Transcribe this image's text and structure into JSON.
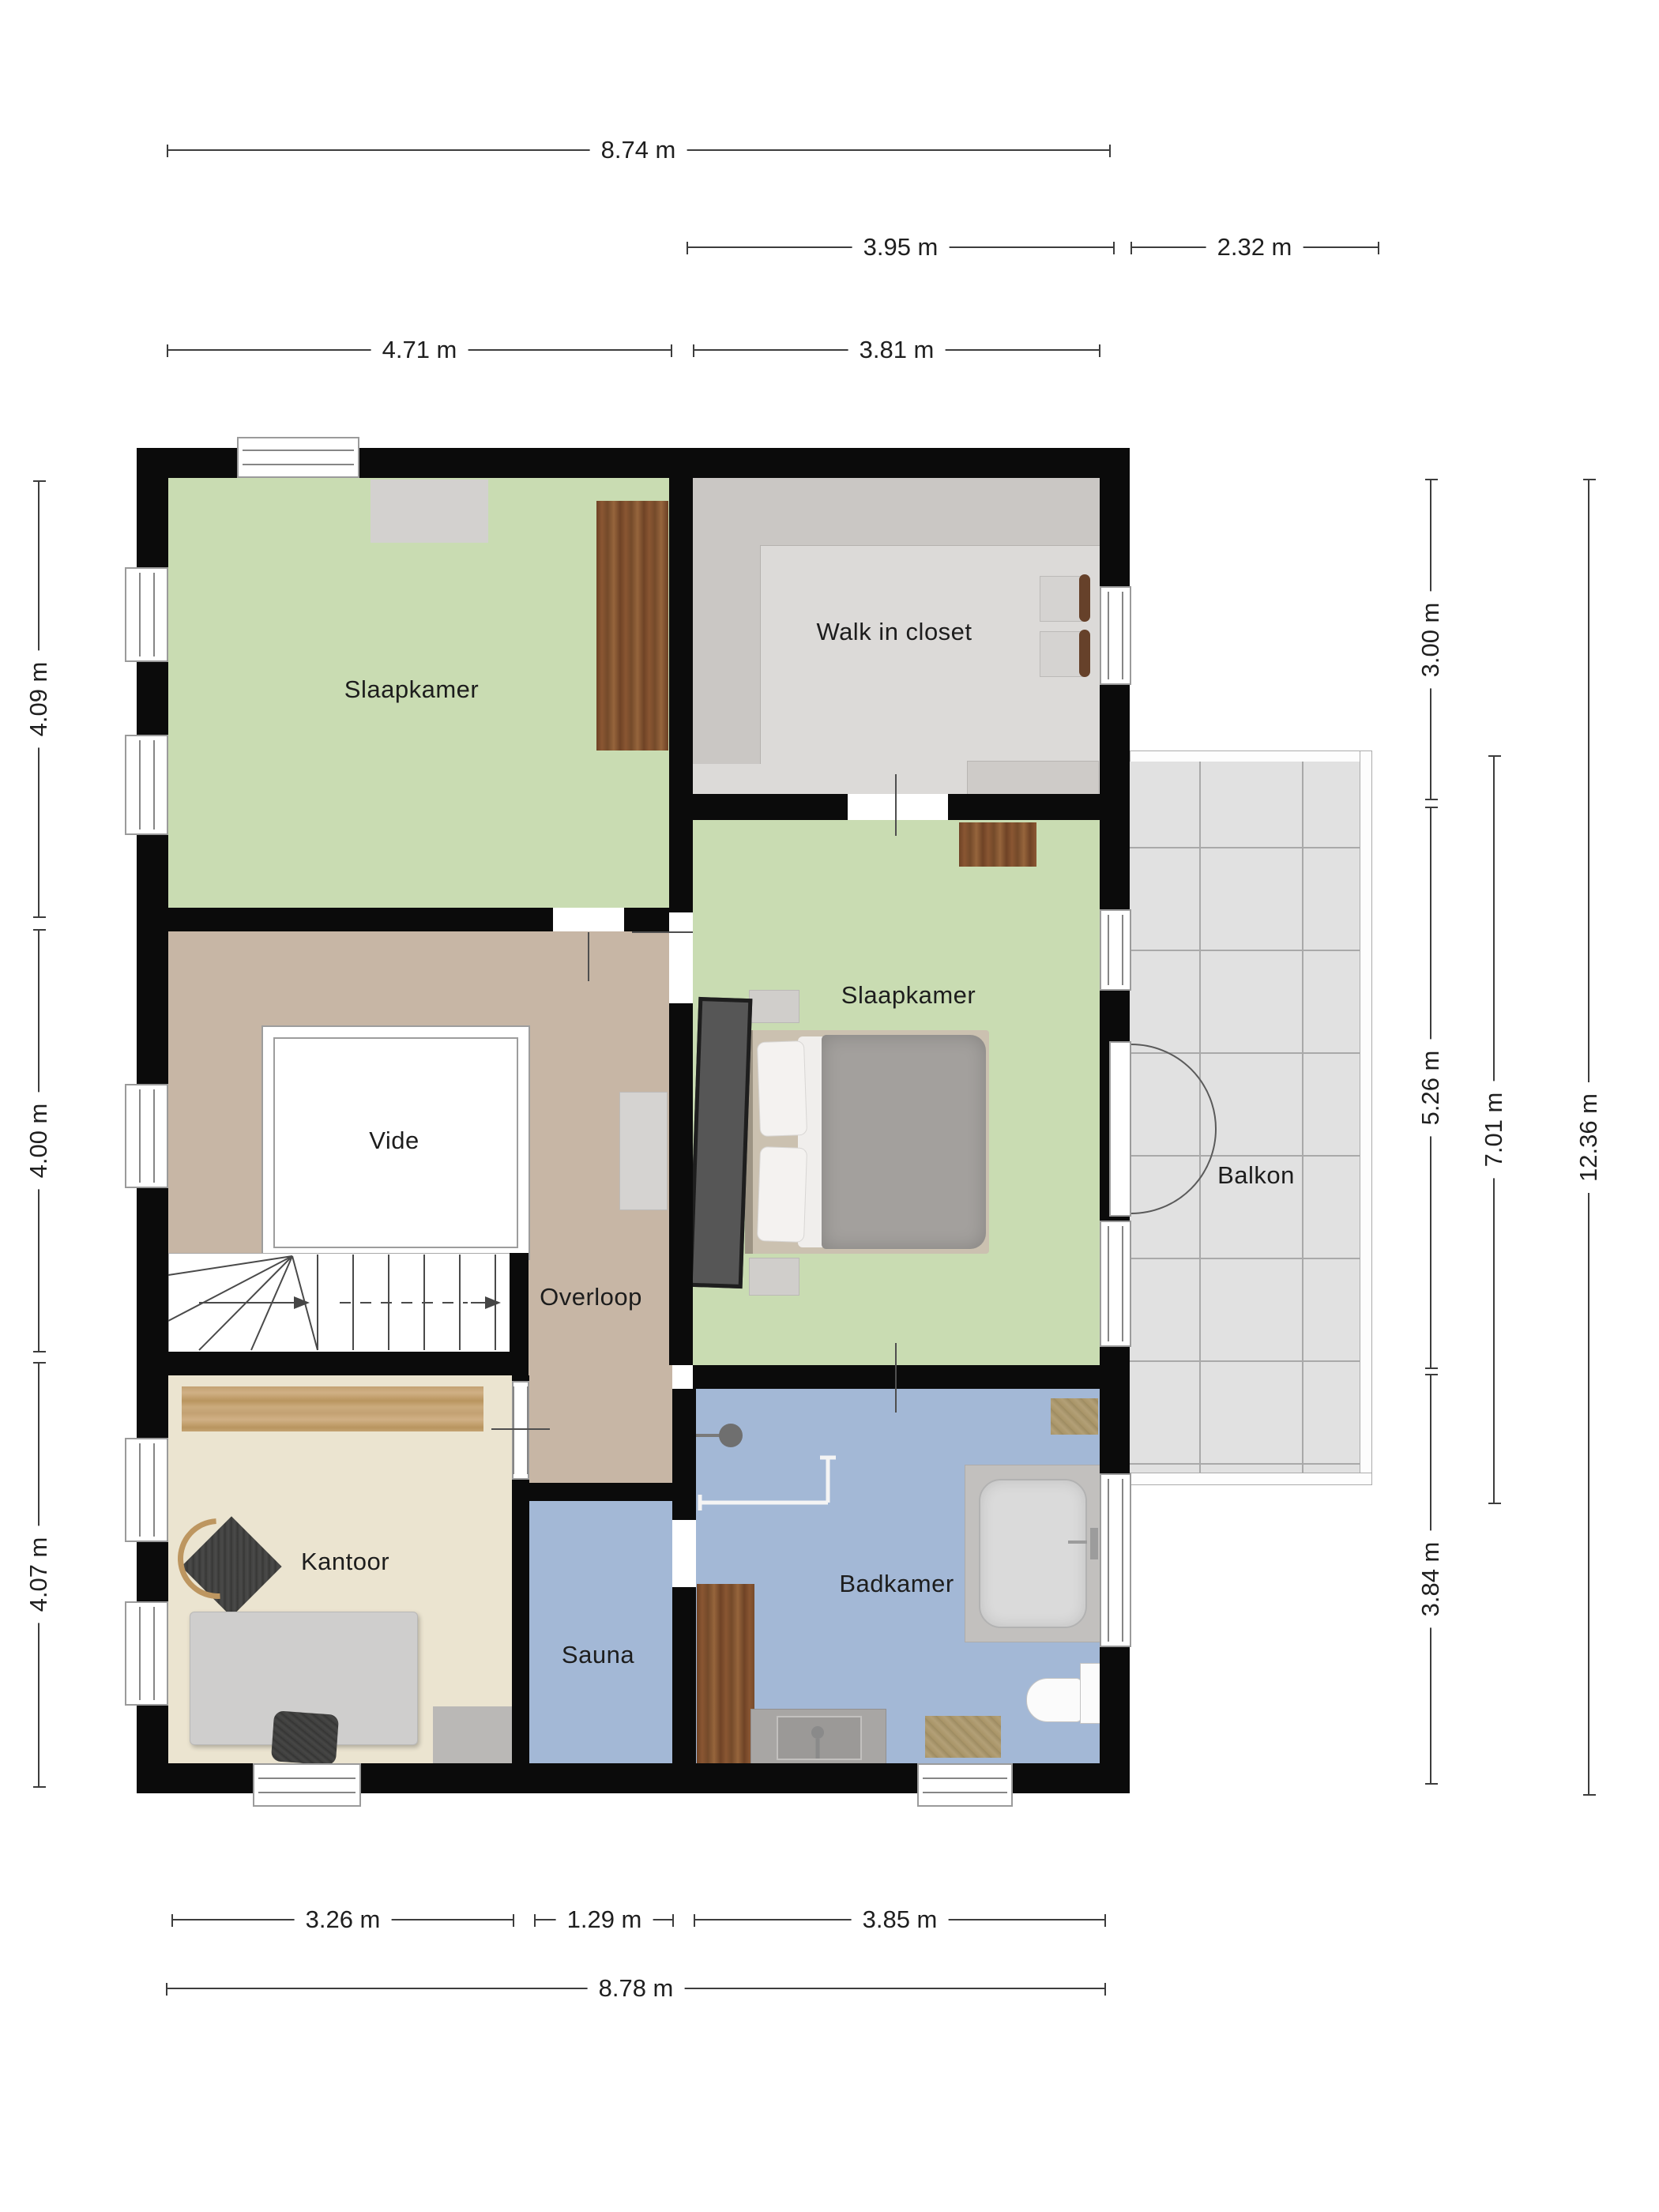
{
  "rooms": {
    "bedroom_top": "Slaapkamer",
    "walk_in_closet": "Walk in closet",
    "bedroom_main": "Slaapkamer",
    "vide": "Vide",
    "overloop": "Overloop",
    "balkon": "Balkon",
    "kantoor": "Kantoor",
    "sauna": "Sauna",
    "badkamer": "Badkamer"
  },
  "dimensions": {
    "total_width_top": "8.74 m",
    "right_section_width": "3.95 m",
    "balcony_width": "2.32 m",
    "bedroom_top_width": "4.71 m",
    "right_rooms_width": "3.81 m",
    "bedroom_top_height": "4.09 m",
    "middle_height": "4.00 m",
    "bottom_height": "4.07 m",
    "closet_height": "3.00 m",
    "bedroom_main_height": "5.26 m",
    "badkamer_height": "3.84 m",
    "balcony_height": "7.01 m",
    "total_height": "12.36 m",
    "kantoor_width": "3.26 m",
    "sauna_width": "1.29 m",
    "badkamer_width": "3.85 m",
    "total_width_bottom": "8.78 m"
  },
  "colors": {
    "wall": "#0b0b0b",
    "bedroom_floor": "#c9dcb2",
    "closet_floor": "#dcdad8",
    "hall_floor": "#c7b6a5",
    "office_floor": "#ebe4d0",
    "bath_floor": "#a3b8d6",
    "balcony_tile": "#e1e1e1"
  }
}
